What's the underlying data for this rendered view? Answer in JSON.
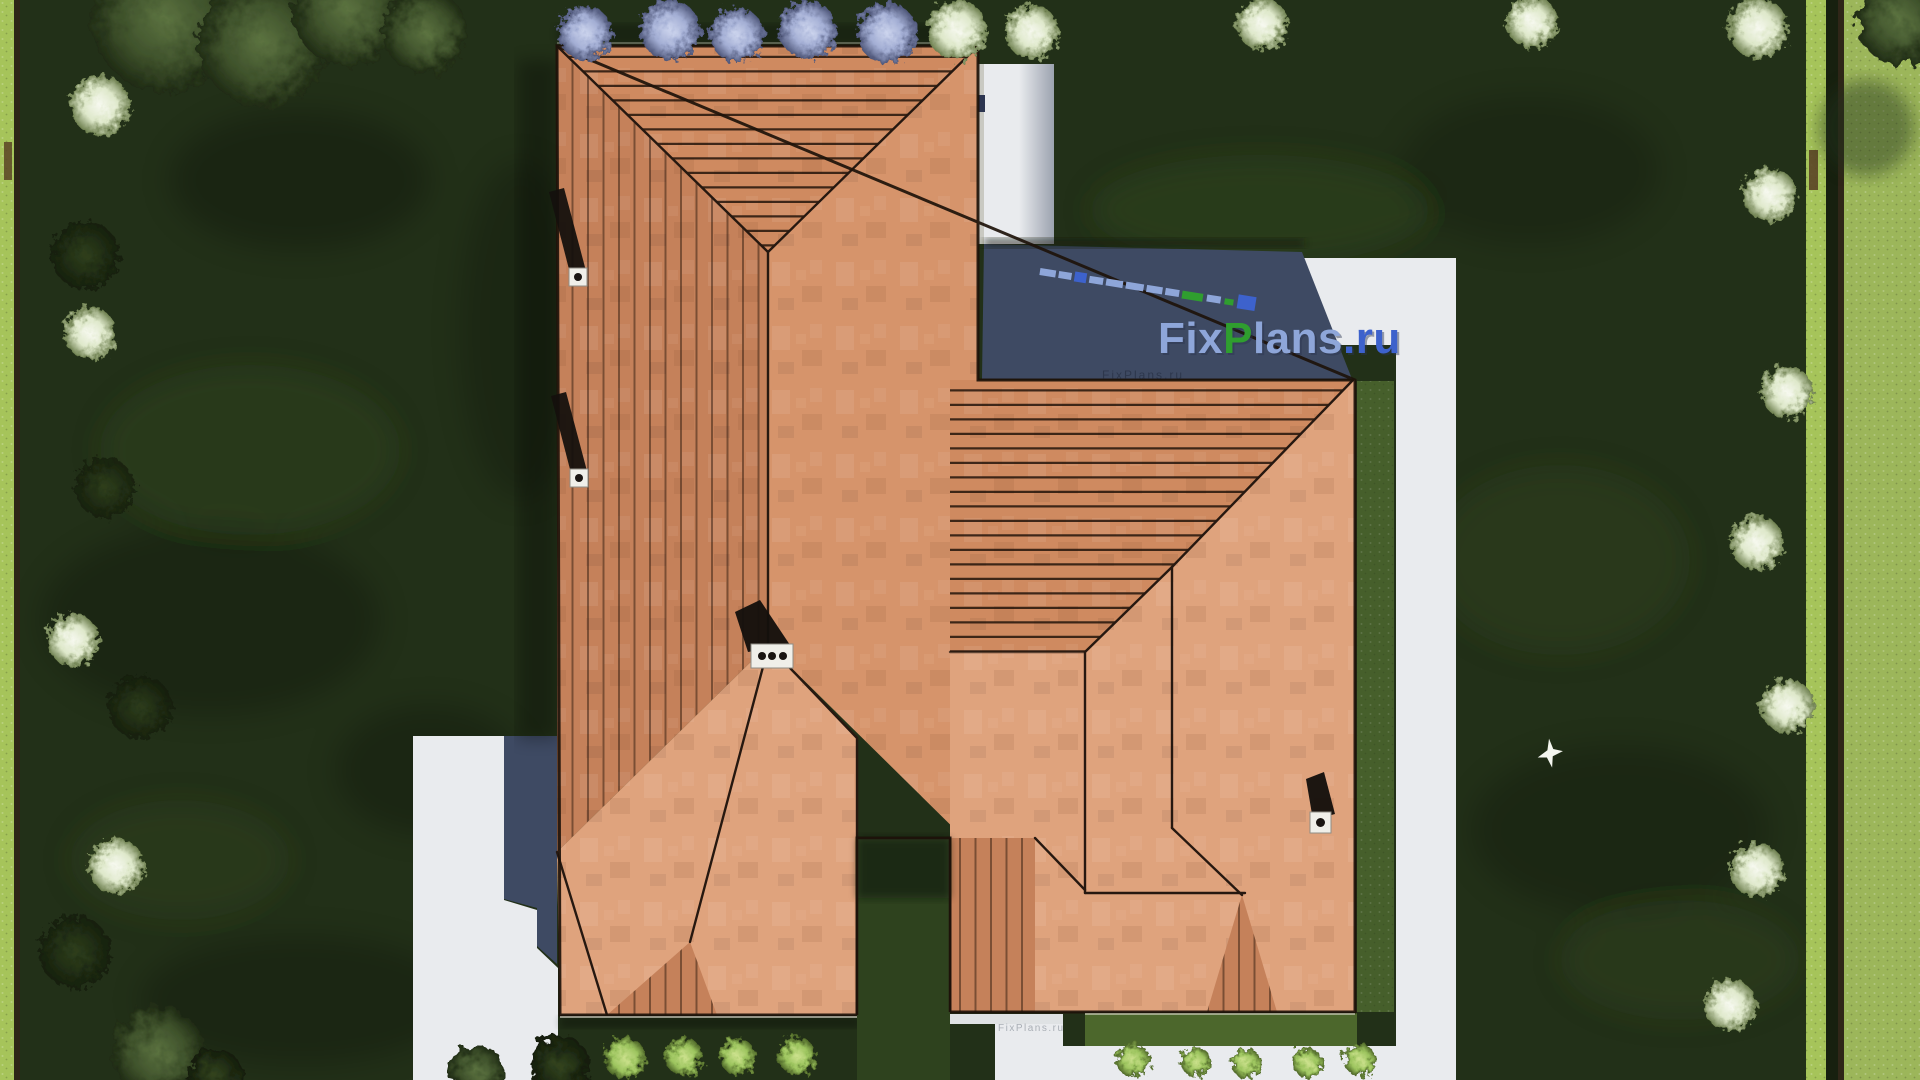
{
  "meta": {
    "title": "Aerial roof-plan render of a country house",
    "view": "top-down 3D architectural visualization",
    "source_watermark": "FixPlans.ru"
  },
  "watermark": {
    "fix": "Fix",
    "p": "P",
    "lans": "lans",
    "dotru": ".ru",
    "full": "FixPlans.ru",
    "faint_line": "FixPlans.ru",
    "path_stamp": "FixPlans.ru"
  },
  "scene": {
    "house": {
      "roof": "terracotta tile hip roof with multiple wings and battened slopes",
      "chimneys": 4,
      "courtyard": "small lawn notch on the south side between wings"
    },
    "hardscape": {
      "east_walkway": "white concrete path along east wall and property side",
      "south_walkway": "white concrete path along south facade",
      "west_driveway": "white concrete driveway on west side",
      "shadows": "building shadows cast on north-east patio and west driveway"
    },
    "vegetation": {
      "lilac_bushes_top_row": 5,
      "white_flowering_bushes": 15,
      "small_green_bushes_south": 9,
      "corner_trees": "dark olive trees in top-left, bottom-left and top-right corners",
      "boundary_hedges": "bright trimmed hedges along left and right plot edges"
    },
    "wildlife": {
      "bird": "white bird flying over the east lawn"
    }
  },
  "colors": {
    "lawn": "#223018",
    "lawnShade": "#121a0c",
    "lawnLight": "#445c29",
    "hedge": "#a6c45a",
    "fence": "#2f2618",
    "outerLawn": "#9cb65a",
    "path": "#e9ebee",
    "pathShade": "#dfe2e4",
    "gravel": "#c9c9c2",
    "shadow": "#3e4a63",
    "courtyard": "#2e421e",
    "stripGrass": "#4c672c",
    "hedgeStrip": "#465f2b",
    "roofPlain": "#dfa37d",
    "roofEast": "#d6946b",
    "roofMid": "#cf8a60",
    "roofBattens": "#c5815a",
    "ridge": "#261810",
    "chimney": "#f0efe9",
    "chimneyDark": "#1a1512",
    "wmLight": "#8ea6d9",
    "wmGreen": "#2f9e2f",
    "wmBlue": "#3d62cc",
    "wmShadow": "#2a3550",
    "stamp": "#9aa0a8",
    "faint": "#1c2436"
  }
}
